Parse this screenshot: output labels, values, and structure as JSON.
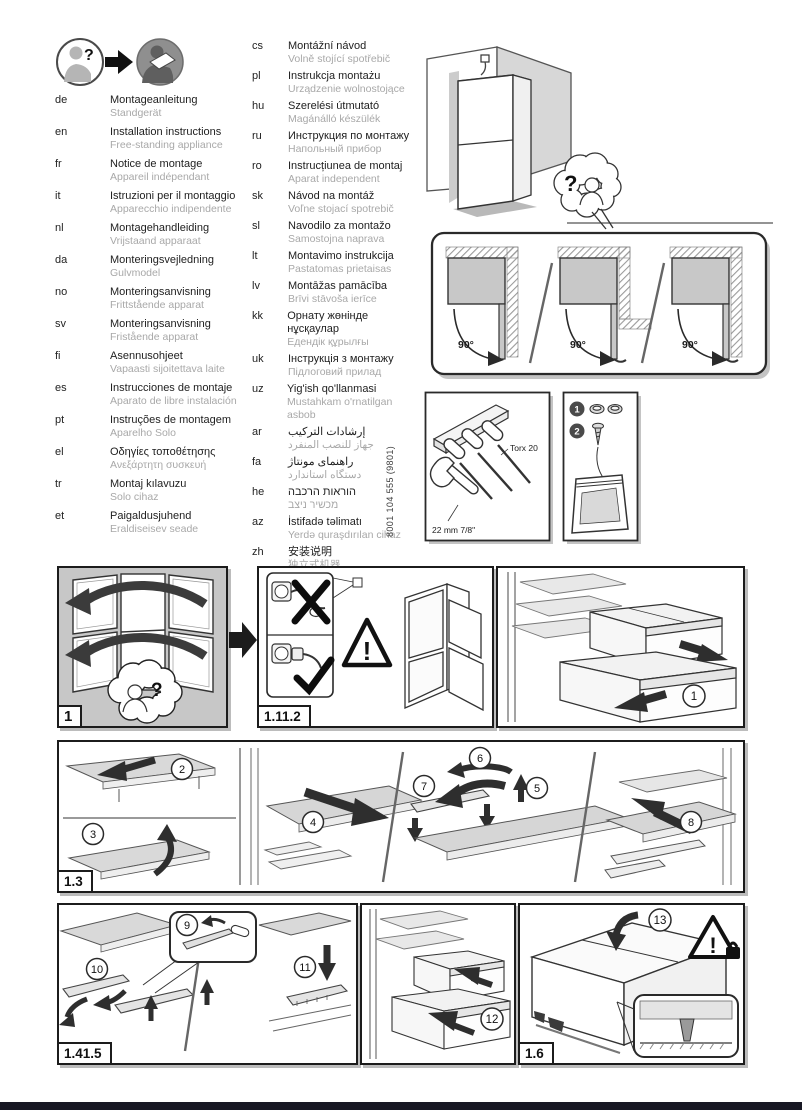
{
  "symbols": {
    "question": "?",
    "exclamation": "!"
  },
  "doc_number": "8001 104 555 (9801)",
  "languages_left": [
    {
      "code": "de",
      "title": "Montageanleitung",
      "subtitle": "Standgerät"
    },
    {
      "code": "en",
      "title": "Installation instructions",
      "subtitle": "Free-standing appliance"
    },
    {
      "code": "fr",
      "title": "Notice de montage",
      "subtitle": "Appareil indépendant"
    },
    {
      "code": "it",
      "title": "Istruzioni per il montaggio",
      "subtitle": "Apparecchio indipendente"
    },
    {
      "code": "nl",
      "title": "Montagehandleiding",
      "subtitle": "Vrijstaand apparaat"
    },
    {
      "code": "da",
      "title": "Monteringsvejledning",
      "subtitle": "Gulvmodel"
    },
    {
      "code": "no",
      "title": "Monteringsanvisning",
      "subtitle": "Frittstående apparat"
    },
    {
      "code": "sv",
      "title": "Monteringsanvisning",
      "subtitle": "Fristående apparat"
    },
    {
      "code": "fi",
      "title": "Asennusohjeet",
      "subtitle": "Vapaasti sijoitettava laite"
    },
    {
      "code": "es",
      "title": "Instrucciones de montaje",
      "subtitle": "Aparato de libre instalación"
    },
    {
      "code": "pt",
      "title": "Instruções de montagem",
      "subtitle": "Aparelho Solo"
    },
    {
      "code": "el",
      "title": "Οδηγίες τοποθέτησης",
      "subtitle": "Ανεξάρτητη συσκευή"
    },
    {
      "code": "tr",
      "title": "Montaj kılavuzu",
      "subtitle": "Solo cihaz"
    },
    {
      "code": "et",
      "title": "Paigaldusjuhend",
      "subtitle": "Eraldiseisev seade"
    }
  ],
  "languages_right": [
    {
      "code": "cs",
      "title": "Montážní návod",
      "subtitle": "Volně stojící spotřebič"
    },
    {
      "code": "pl",
      "title": "Instrukcja montażu",
      "subtitle": "Urządzenie wolnostojące"
    },
    {
      "code": "hu",
      "title": "Szerelési útmutató",
      "subtitle": "Magánálló készülék"
    },
    {
      "code": "ru",
      "title": "Инструкция по монтажу",
      "subtitle": "Напольный прибор"
    },
    {
      "code": "ro",
      "title": "Instrucțiunea de montaj",
      "subtitle": "Aparat independent"
    },
    {
      "code": "sk",
      "title": "Návod na montáž",
      "subtitle": "Voľne stojací spotrebič"
    },
    {
      "code": "sl",
      "title": "Navodilo za montažo",
      "subtitle": "Samostojna naprava"
    },
    {
      "code": "lt",
      "title": "Montavimo instrukcija",
      "subtitle": "Pastatomas prietaisas"
    },
    {
      "code": "lv",
      "title": "Montāžas pamācība",
      "subtitle": "Brīvi stāvoša ierīce"
    },
    {
      "code": "kk",
      "title": "Орнату жөнінде нұсқаулар",
      "subtitle": "Едендік құрылғы"
    },
    {
      "code": "uk",
      "title": "Інструкція з монтажу",
      "subtitle": "Підлоговий прилад"
    },
    {
      "code": "uz",
      "title": "Yig'ish qo'llanmasi",
      "subtitle": "Mustahkam o'rnatilgan asbob"
    },
    {
      "code": "ar",
      "title": "إرشادات التركيب",
      "subtitle": "جهاز للنصب المنفرد",
      "rtl": true
    },
    {
      "code": "fa",
      "title": "راهنمای مونتاژ",
      "subtitle": "دستگاه استاندارد",
      "rtl": true
    },
    {
      "code": "he",
      "title": "הוראות הרכבה",
      "subtitle": "מכשיר ניצב",
      "rtl": true
    },
    {
      "code": "az",
      "title": "İstifadə təlimatı",
      "subtitle": "Yerdə quraşdırılan cihaz"
    },
    {
      "code": "zh",
      "title": "安装说明",
      "subtitle": "独立式机器"
    }
  ],
  "door_clearance": {
    "angles": [
      "90°",
      "90°",
      "90°"
    ]
  },
  "tools": {
    "torx_label": "Torx 20",
    "wrench_label": "22 mm  7/8\""
  },
  "parts": {
    "item_numbers": [
      "1",
      "2"
    ]
  },
  "panel_labels": {
    "p1": "1",
    "p1112": "1.11.2",
    "p13": "1.3",
    "p1415": "1.41.5",
    "p16": "1.6"
  },
  "steps": [
    "1",
    "2",
    "3",
    "4",
    "5",
    "6",
    "7",
    "8",
    "9",
    "10",
    "11",
    "12",
    "13"
  ],
  "colors": {
    "panel_gray": "#c7c7c7",
    "subtitle_gray": "#a8a8a8",
    "line_dark": "#1c1c1c"
  }
}
